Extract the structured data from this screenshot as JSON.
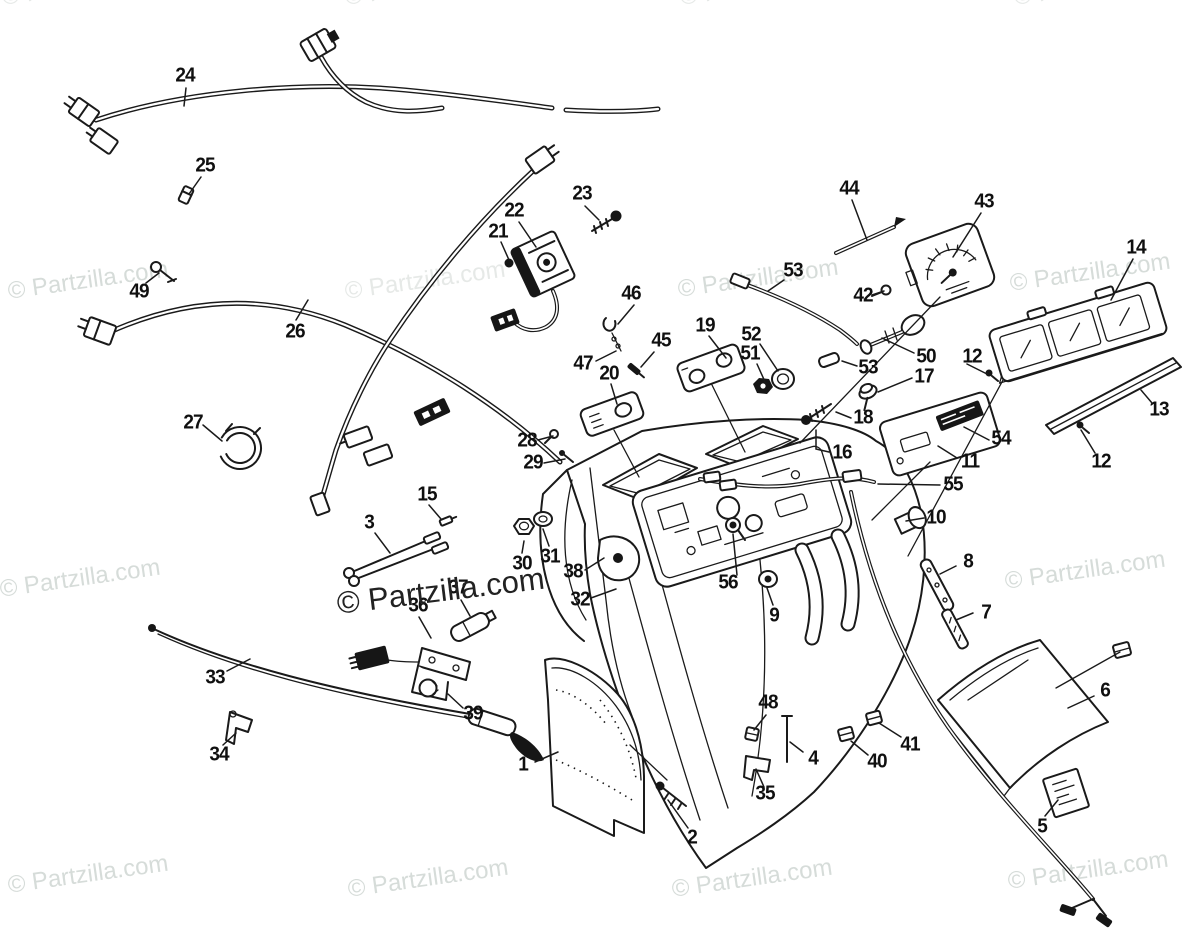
{
  "diagram": {
    "description": "Exploded OEM parts diagram - console, instruments and wiring",
    "background_color": "#ffffff",
    "line_color": "#1a1a1a",
    "label_color": "#101010",
    "watermark": {
      "text": "© Partzilla.com",
      "light_color": "#d6dcd9",
      "faint_color": "#e6e9e7",
      "dark_color": "#222222"
    },
    "watermarks": [
      {
        "x": 2,
        "y": -16,
        "tone": "faint"
      },
      {
        "x": 345,
        "y": -16,
        "tone": "faint"
      },
      {
        "x": 680,
        "y": -16,
        "tone": "faint"
      },
      {
        "x": 1014,
        "y": -16,
        "tone": "faint"
      },
      {
        "x": 8,
        "y": 278,
        "tone": "light"
      },
      {
        "x": 345,
        "y": 278,
        "tone": "faint"
      },
      {
        "x": 678,
        "y": 276,
        "tone": "light"
      },
      {
        "x": 1010,
        "y": 270,
        "tone": "light"
      },
      {
        "x": 0,
        "y": 576,
        "tone": "light"
      },
      {
        "x": 337,
        "y": 586,
        "tone": "dark"
      },
      {
        "x": 668,
        "y": 580,
        "tone": "light"
      },
      {
        "x": 1005,
        "y": 568,
        "tone": "light"
      },
      {
        "x": 8,
        "y": 872,
        "tone": "light"
      },
      {
        "x": 348,
        "y": 876,
        "tone": "light"
      },
      {
        "x": 672,
        "y": 876,
        "tone": "light"
      },
      {
        "x": 1008,
        "y": 868,
        "tone": "light"
      }
    ],
    "part_labels": [
      {
        "id": "1",
        "text": "1",
        "x": 523,
        "y": 765
      },
      {
        "id": "2",
        "text": "2",
        "x": 692,
        "y": 838
      },
      {
        "id": "3",
        "text": "3",
        "x": 369,
        "y": 523
      },
      {
        "id": "4",
        "text": "4",
        "x": 813,
        "y": 759
      },
      {
        "id": "5",
        "text": "5",
        "x": 1042,
        "y": 827
      },
      {
        "id": "6",
        "text": "6",
        "x": 1105,
        "y": 691
      },
      {
        "id": "7",
        "text": "7",
        "x": 986,
        "y": 613
      },
      {
        "id": "8",
        "text": "8",
        "x": 968,
        "y": 562
      },
      {
        "id": "9",
        "text": "9",
        "x": 774,
        "y": 616
      },
      {
        "id": "10",
        "text": "10",
        "x": 936,
        "y": 518
      },
      {
        "id": "11",
        "text": "11",
        "x": 970,
        "y": 462
      },
      {
        "id": "12a",
        "text": "12",
        "x": 972,
        "y": 357
      },
      {
        "id": "12b",
        "text": "12",
        "x": 1101,
        "y": 462
      },
      {
        "id": "13",
        "text": "13",
        "x": 1159,
        "y": 410
      },
      {
        "id": "14",
        "text": "14",
        "x": 1136,
        "y": 248
      },
      {
        "id": "15",
        "text": "15",
        "x": 427,
        "y": 495
      },
      {
        "id": "16",
        "text": "16",
        "x": 842,
        "y": 453
      },
      {
        "id": "17",
        "text": "17",
        "x": 924,
        "y": 377
      },
      {
        "id": "18",
        "text": "18",
        "x": 863,
        "y": 418
      },
      {
        "id": "19",
        "text": "19",
        "x": 705,
        "y": 326
      },
      {
        "id": "20",
        "text": "20",
        "x": 609,
        "y": 374
      },
      {
        "id": "21",
        "text": "21",
        "x": 498,
        "y": 232
      },
      {
        "id": "22",
        "text": "22",
        "x": 514,
        "y": 211
      },
      {
        "id": "23",
        "text": "23",
        "x": 582,
        "y": 194
      },
      {
        "id": "24",
        "text": "24",
        "x": 185,
        "y": 76
      },
      {
        "id": "25",
        "text": "25",
        "x": 205,
        "y": 166
      },
      {
        "id": "26",
        "text": "26",
        "x": 295,
        "y": 332
      },
      {
        "id": "27",
        "text": "27",
        "x": 193,
        "y": 423
      },
      {
        "id": "28",
        "text": "28",
        "x": 527,
        "y": 441
      },
      {
        "id": "29",
        "text": "29",
        "x": 533,
        "y": 463
      },
      {
        "id": "30",
        "text": "30",
        "x": 522,
        "y": 564
      },
      {
        "id": "31",
        "text": "31",
        "x": 550,
        "y": 557
      },
      {
        "id": "32",
        "text": "32",
        "x": 580,
        "y": 600
      },
      {
        "id": "33",
        "text": "33",
        "x": 215,
        "y": 678
      },
      {
        "id": "34",
        "text": "34",
        "x": 219,
        "y": 755
      },
      {
        "id": "35",
        "text": "35",
        "x": 765,
        "y": 794
      },
      {
        "id": "36",
        "text": "36",
        "x": 418,
        "y": 606
      },
      {
        "id": "37",
        "text": "37",
        "x": 458,
        "y": 588
      },
      {
        "id": "38",
        "text": "38",
        "x": 573,
        "y": 572
      },
      {
        "id": "39",
        "text": "39",
        "x": 473,
        "y": 714
      },
      {
        "id": "40",
        "text": "40",
        "x": 877,
        "y": 762
      },
      {
        "id": "41",
        "text": "41",
        "x": 910,
        "y": 745
      },
      {
        "id": "42",
        "text": "42",
        "x": 863,
        "y": 296
      },
      {
        "id": "43",
        "text": "43",
        "x": 984,
        "y": 202
      },
      {
        "id": "44",
        "text": "44",
        "x": 849,
        "y": 189
      },
      {
        "id": "45",
        "text": "45",
        "x": 661,
        "y": 341
      },
      {
        "id": "46",
        "text": "46",
        "x": 631,
        "y": 294
      },
      {
        "id": "47",
        "text": "47",
        "x": 583,
        "y": 364
      },
      {
        "id": "48",
        "text": "48",
        "x": 768,
        "y": 703
      },
      {
        "id": "49",
        "text": "49",
        "x": 139,
        "y": 292
      },
      {
        "id": "50",
        "text": "50",
        "x": 926,
        "y": 357
      },
      {
        "id": "51",
        "text": "51",
        "x": 750,
        "y": 354
      },
      {
        "id": "52",
        "text": "52",
        "x": 751,
        "y": 335
      },
      {
        "id": "53a",
        "text": "53",
        "x": 793,
        "y": 271
      },
      {
        "id": "53b",
        "text": "53",
        "x": 868,
        "y": 368
      },
      {
        "id": "54",
        "text": "54",
        "x": 1001,
        "y": 439
      },
      {
        "id": "55",
        "text": "55",
        "x": 953,
        "y": 485
      },
      {
        "id": "56",
        "text": "56",
        "x": 728,
        "y": 583
      }
    ]
  }
}
